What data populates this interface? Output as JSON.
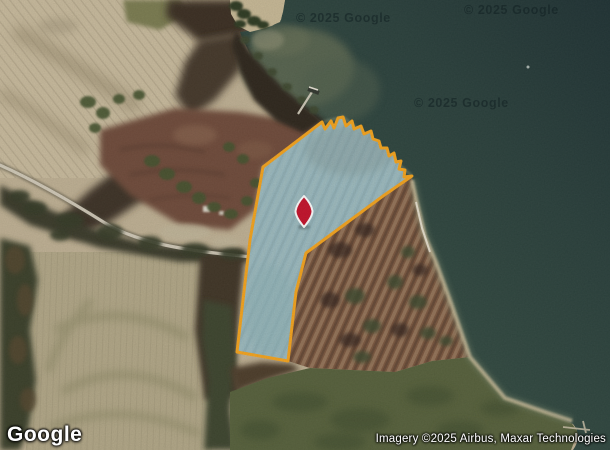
{
  "map": {
    "provider_logo": "Google",
    "attribution": "Imagery ©2025 Airbus, Maxar Technologies",
    "watermarks": [
      "© 2025 Google",
      "© 2025 Google",
      "© 2025 Google"
    ]
  },
  "parcel": {
    "stroke_color": "#F7A51D",
    "fill_color": "rgba(160,225,245,0.5)",
    "points": [
      [
        263,
        167
      ],
      [
        322,
        122
      ],
      [
        325,
        129
      ],
      [
        331,
        121
      ],
      [
        334,
        128
      ],
      [
        338,
        118
      ],
      [
        343,
        117
      ],
      [
        346,
        126
      ],
      [
        352,
        121
      ],
      [
        354,
        129
      ],
      [
        361,
        126
      ],
      [
        364,
        134
      ],
      [
        371,
        131
      ],
      [
        373,
        139
      ],
      [
        379,
        141
      ],
      [
        381,
        148
      ],
      [
        387,
        148
      ],
      [
        389,
        156
      ],
      [
        394,
        153
      ],
      [
        396,
        162
      ],
      [
        401,
        161
      ],
      [
        399,
        169
      ],
      [
        405,
        170
      ],
      [
        404,
        177
      ],
      [
        412,
        176
      ],
      [
        383,
        196
      ],
      [
        306,
        253
      ],
      [
        296,
        292
      ],
      [
        288,
        361
      ],
      [
        237,
        352
      ],
      [
        250,
        240
      ]
    ]
  },
  "marker": {
    "color": "#C6112B",
    "outline_color": "#FFFFFF",
    "x": 304,
    "y": 211
  }
}
